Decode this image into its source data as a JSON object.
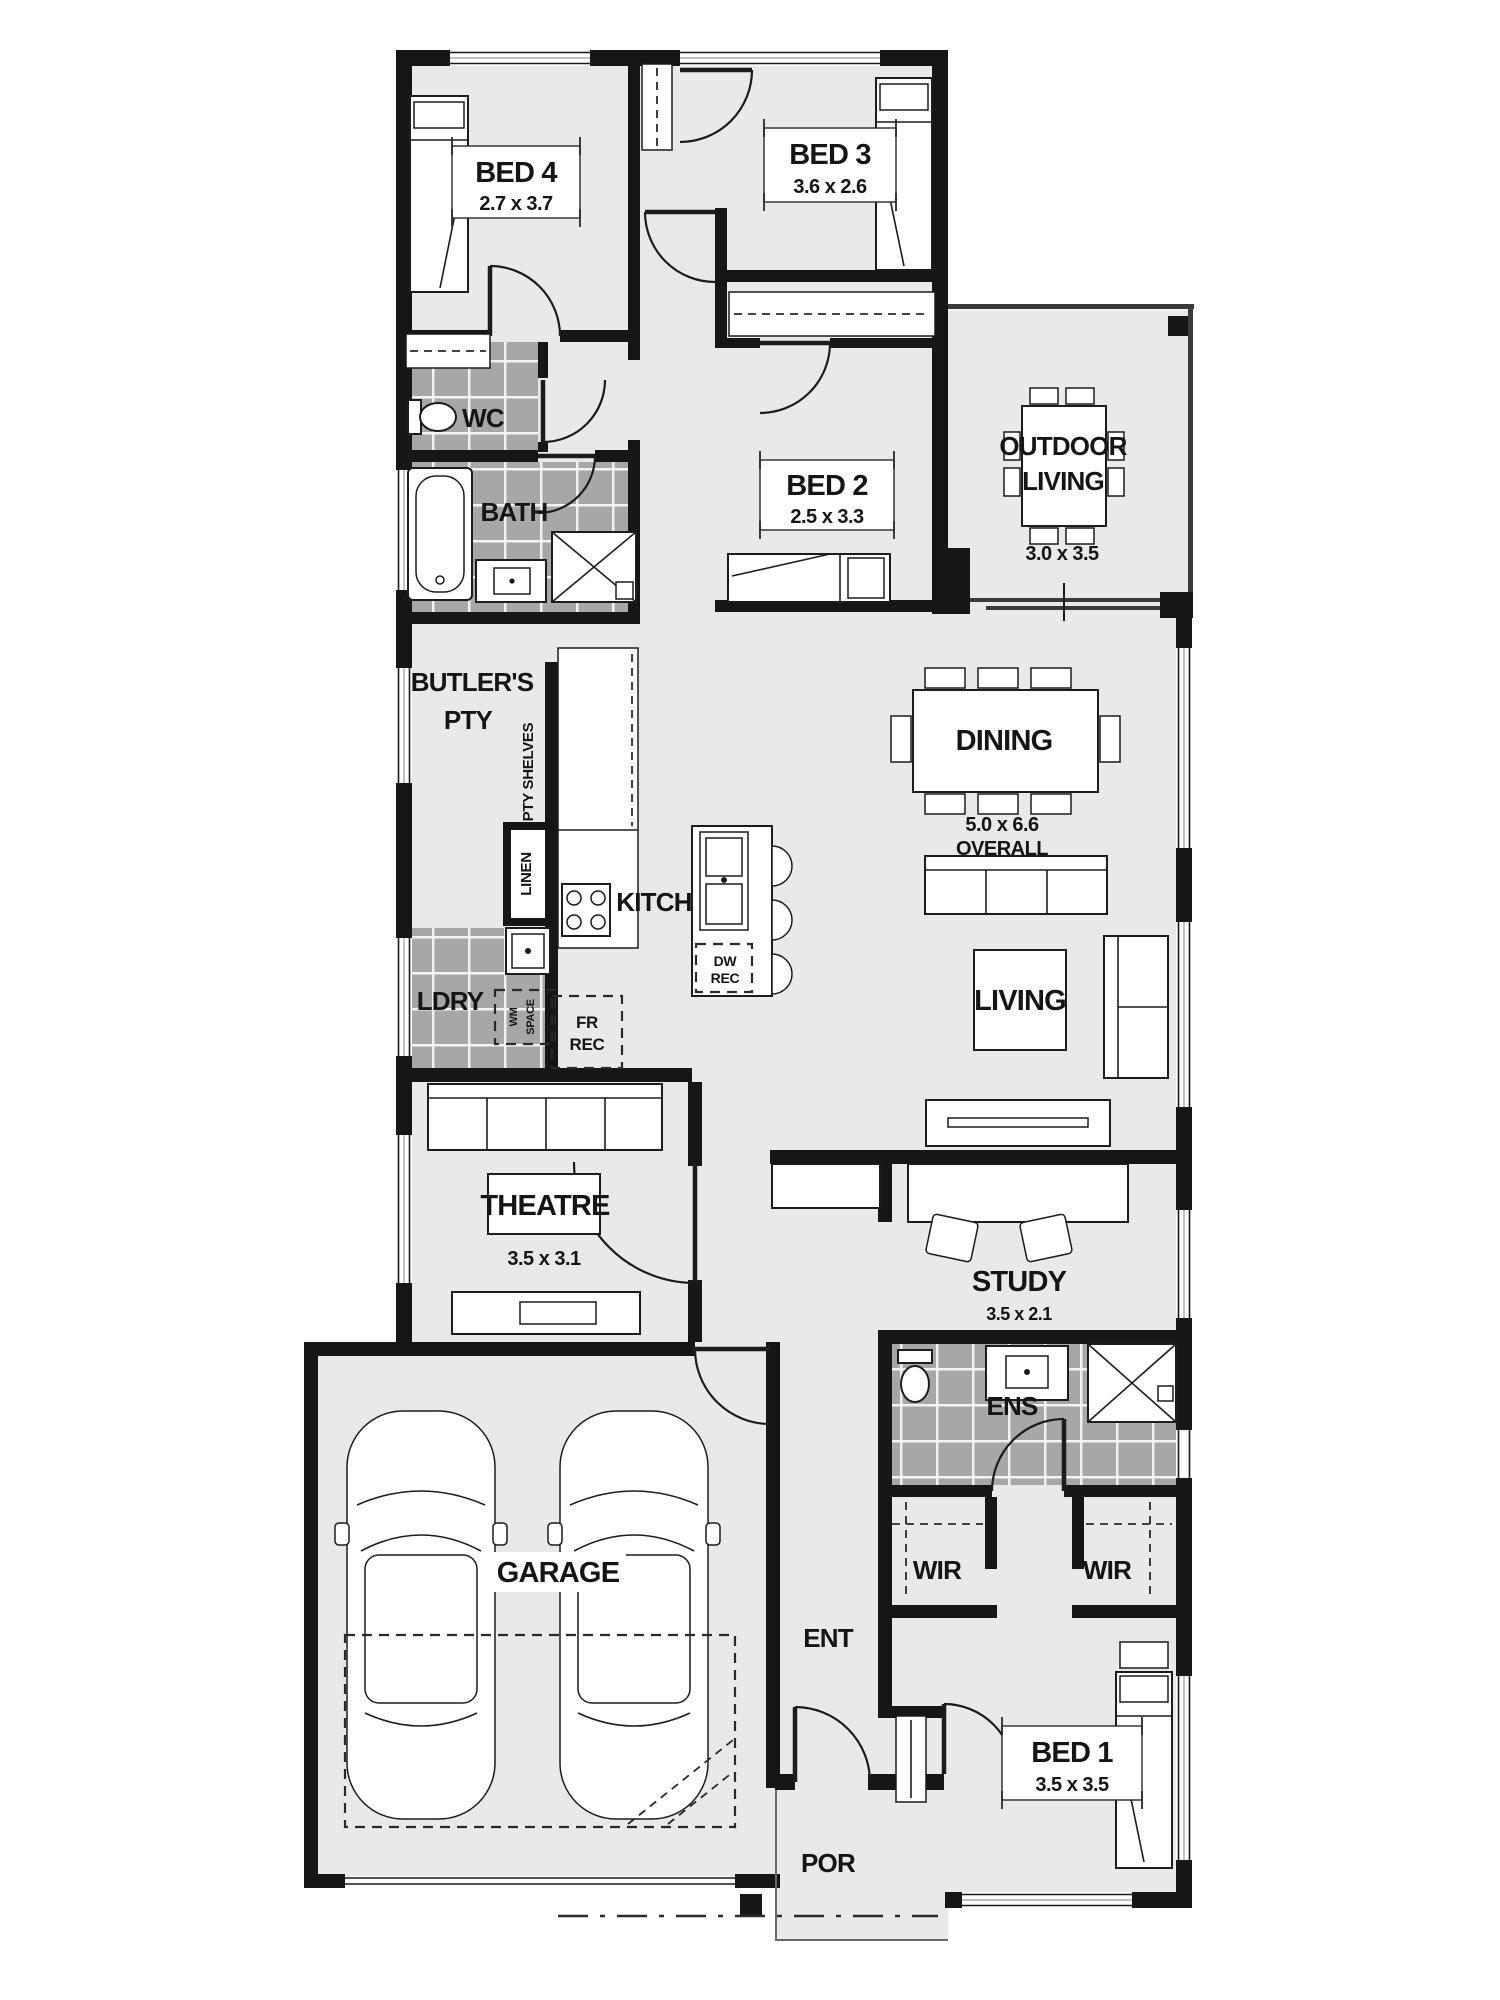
{
  "plan_type": "floor-plan",
  "rooms": {
    "bed4": {
      "name": "BED 4",
      "dims": "2.7 x 3.7"
    },
    "bed3": {
      "name": "BED 3",
      "dims": "3.6 x 2.6"
    },
    "bed2": {
      "name": "BED 2",
      "dims": "2.5 x 3.3"
    },
    "bed1": {
      "name": "BED 1",
      "dims": "3.5 x 3.5"
    },
    "wc": {
      "name": "WC"
    },
    "bath": {
      "name": "BATH"
    },
    "outdoor_living": {
      "line1": "OUTDOOR",
      "line2": "LIVING",
      "dims": "3.0 x 3.5"
    },
    "butlers_pantry": {
      "line1": "BUTLER'S",
      "line2": "PTY"
    },
    "pantry_shelves": {
      "label": "PTY SHELVES"
    },
    "linen": {
      "label": "LINEN"
    },
    "kitchen": {
      "name": "KITCH"
    },
    "dishwasher_recess": {
      "line1": "DW",
      "line2": "REC"
    },
    "laundry": {
      "name": "LDRY"
    },
    "washing_machine_space": {
      "line1": "WM",
      "line2": "SPACE"
    },
    "fridge_recess": {
      "line1": "FR",
      "line2": "REC"
    },
    "dining": {
      "name": "DINING",
      "dims_line1": "5.0 x 6.6",
      "dims_line2": "OVERALL"
    },
    "living": {
      "name": "LIVING"
    },
    "theatre": {
      "name": "THEATRE",
      "dims": "3.5 x 3.1"
    },
    "study": {
      "name": "STUDY",
      "dims": "3.5 x 2.1"
    },
    "ensuite": {
      "name": "ENS"
    },
    "wir_left": {
      "name": "WIR"
    },
    "wir_right": {
      "name": "WIR"
    },
    "garage": {
      "name": "GARAGE"
    },
    "entry": {
      "name": "ENT"
    },
    "porch": {
      "name": "POR"
    }
  },
  "colors": {
    "wall": "#161616",
    "floor": "#e9e9e9",
    "tile": "#a7a7a7",
    "tile_line": "#ffffff",
    "line": "#1c1c1c"
  }
}
